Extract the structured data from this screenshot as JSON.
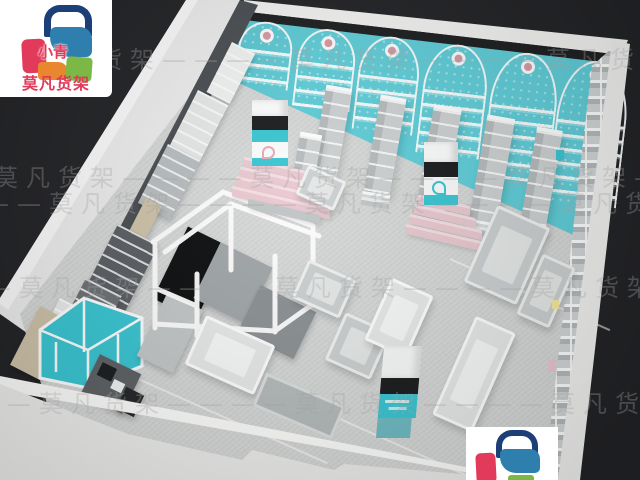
{
  "branding": {
    "logo_icon": "shopping-bag-icon",
    "logo_subtext": "小青",
    "logo_name": "莫凡货架"
  },
  "watermark": {
    "text": "莫凡货架",
    "row_text": "——莫凡货架————莫凡货架————莫凡货架————莫凡货架——"
  },
  "colors": {
    "background": "#222326",
    "floor": "#d6d8d7",
    "wall_teal": "#5fced9",
    "teal_bright": "#38c6d3",
    "teal_dull": "#6ebac3",
    "pink_display": "#e9c8d0",
    "facade_white": "#f3f3f2",
    "fixture_gray": "#c9cdce",
    "fixture_dark": "#55595d",
    "panel_black": "#191b1d",
    "wood_tan": "#cec2a8",
    "logo_red": "#e23a5a",
    "logo_blue": "#2e7fae",
    "logo_navy": "#1d3f77",
    "logo_orange": "#e8872d",
    "logo_green": "#7cb845",
    "watermark_gray": "#9a9a9a"
  }
}
